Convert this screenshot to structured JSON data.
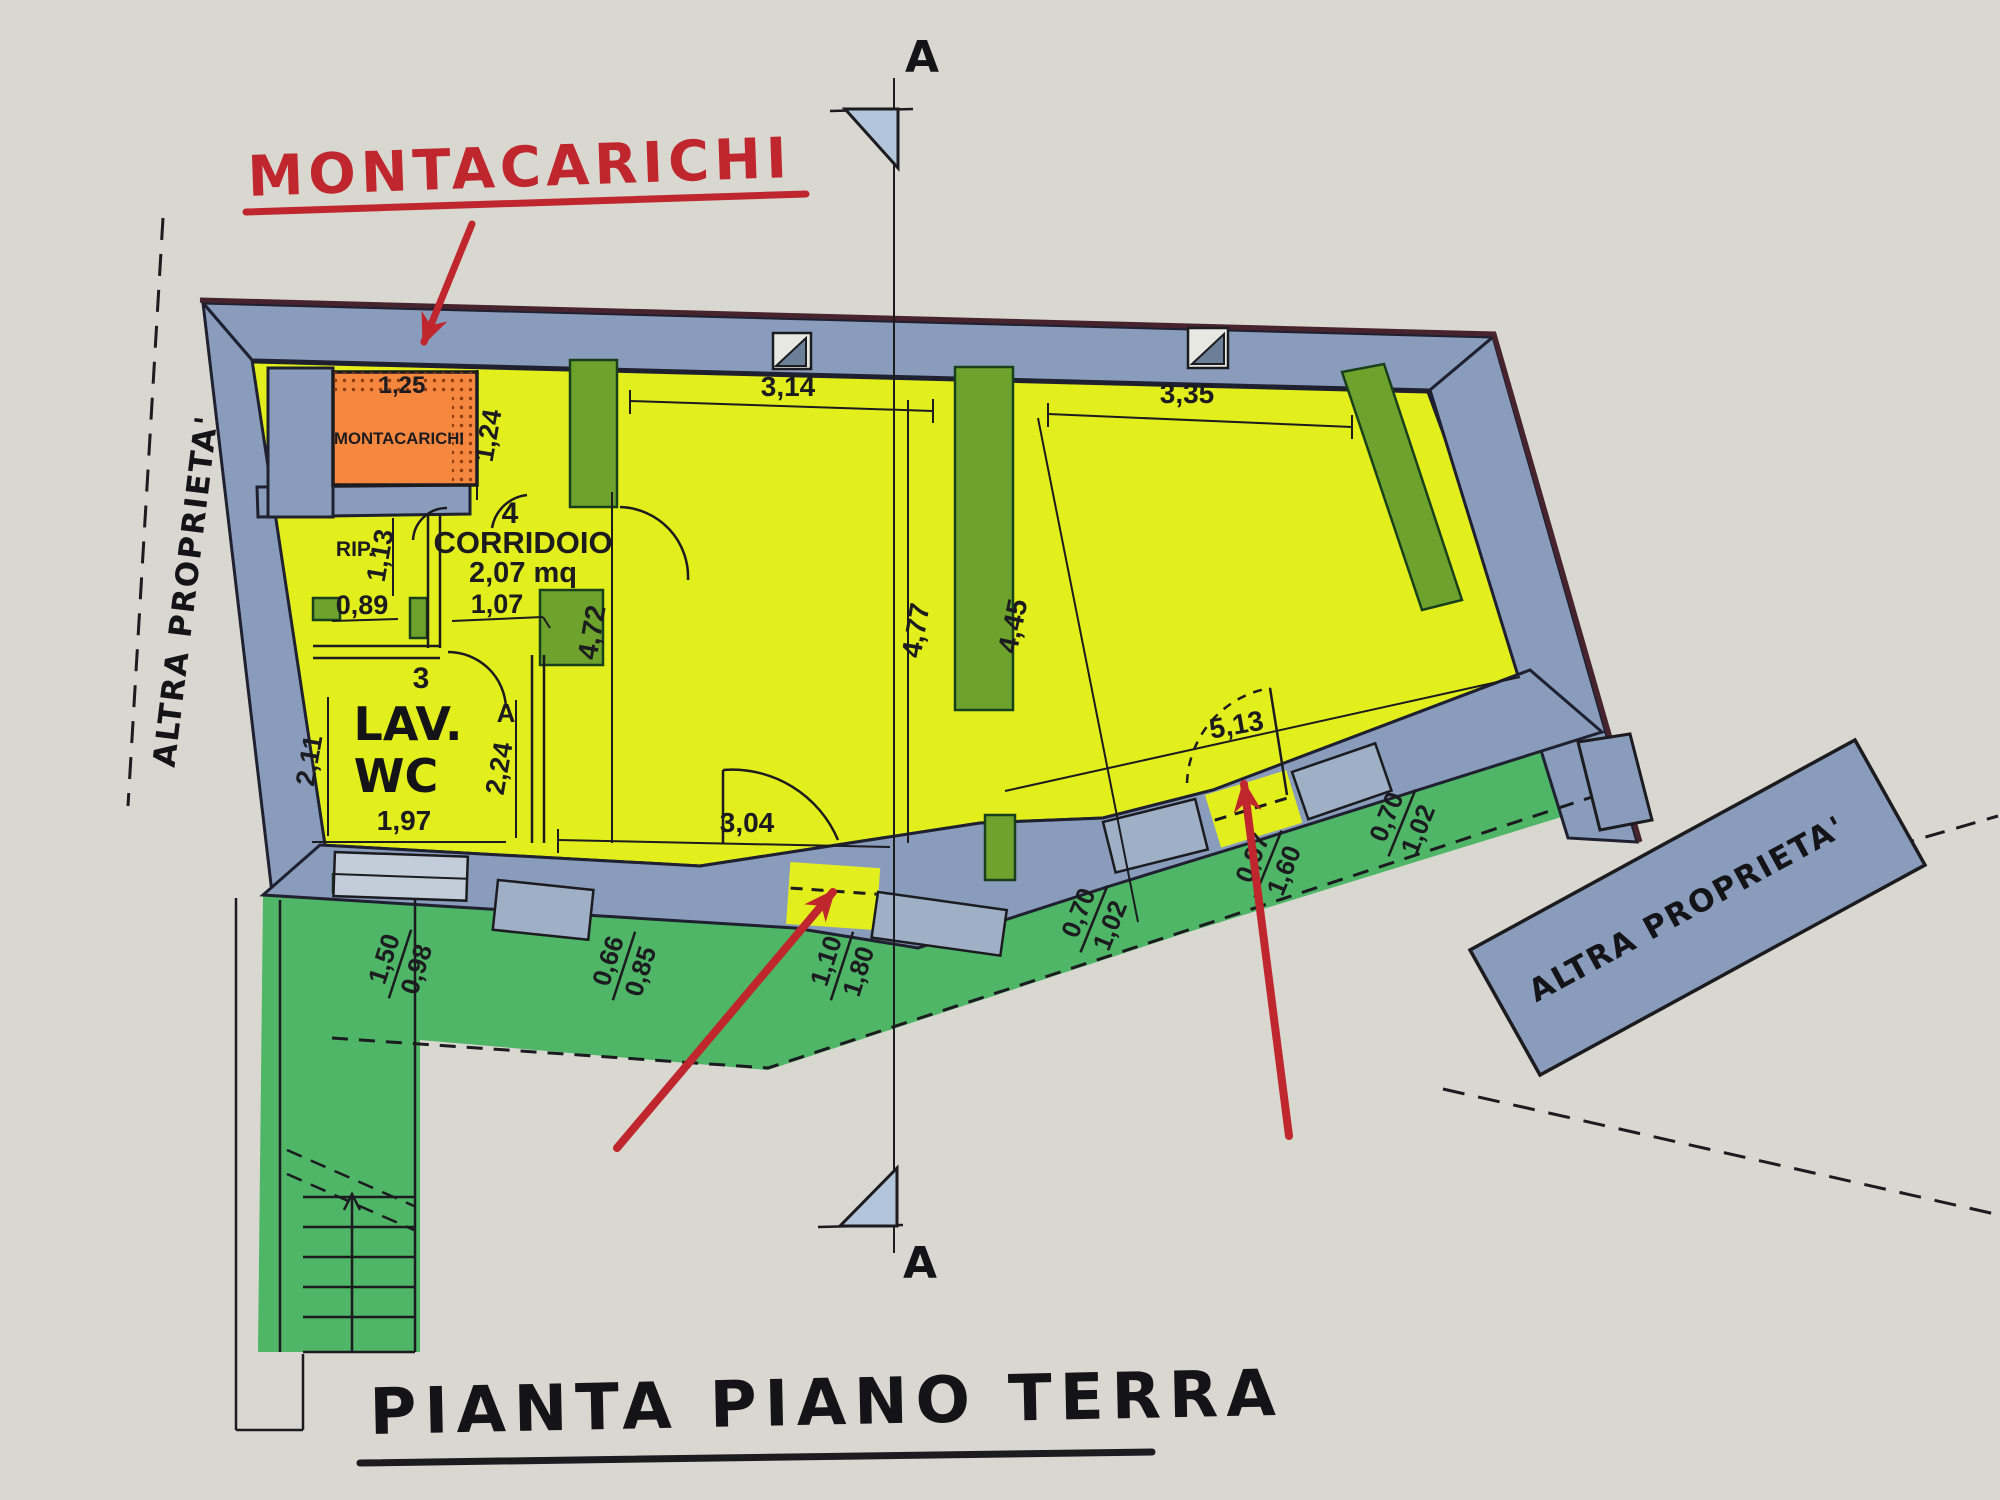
{
  "title": {
    "text": "PIANTA PIANO TERRA"
  },
  "annotations": {
    "montacarichi_callout": "MONTACARICHI",
    "section_top": "A",
    "section_bottom": "A",
    "property_left": "ALTRA PROPRIETA'",
    "property_right": "ALTRA PROPRIETA'"
  },
  "rooms": {
    "montacarichi": {
      "label": "MONTACARICHI",
      "dim_width": "1,25",
      "dim_height": "1,24"
    },
    "rip": {
      "label": "RIP.",
      "dim_width": "0,89",
      "dim_height": "1,13"
    },
    "corridoio": {
      "number": "4",
      "label": "CORRIDOIO",
      "area": "2,07 mq",
      "dim_width": "1,07"
    },
    "lav_wc": {
      "number": "3",
      "label_line1": "LAV.",
      "label_line2": "WC",
      "door_letter": "A",
      "dim_left": "2,11",
      "dim_right": "2,24",
      "dim_bottom": "1,97"
    },
    "central": {
      "dim_top": "3,14",
      "dim_left": "4,72",
      "dim_right": "4,77",
      "dim_bottom": "3,04"
    },
    "right_room": {
      "dim_top": "3,35",
      "dim_left": "4,45",
      "dim_door": "5,13"
    }
  },
  "openings": [
    {
      "width": "1,50",
      "height": "0,98"
    },
    {
      "width": "0,66",
      "height": "0,85"
    },
    {
      "width": "1,10",
      "height": "1,80"
    },
    {
      "width": "0,70",
      "height": "1,02"
    },
    {
      "width": "0,97",
      "height": "1,60"
    },
    {
      "width": "0,70",
      "height": "1,02"
    }
  ],
  "colors": {
    "paper": "#d8d7d0",
    "wall": "#8a9cbb",
    "room_yellow": "#e2ef1c",
    "exterior_green": "#3fb35a",
    "wall_green": "#6da32c",
    "montacarichi_orange": "#f6873e",
    "annotation_red": "#c0262d",
    "ink": "#1b1b20"
  }
}
